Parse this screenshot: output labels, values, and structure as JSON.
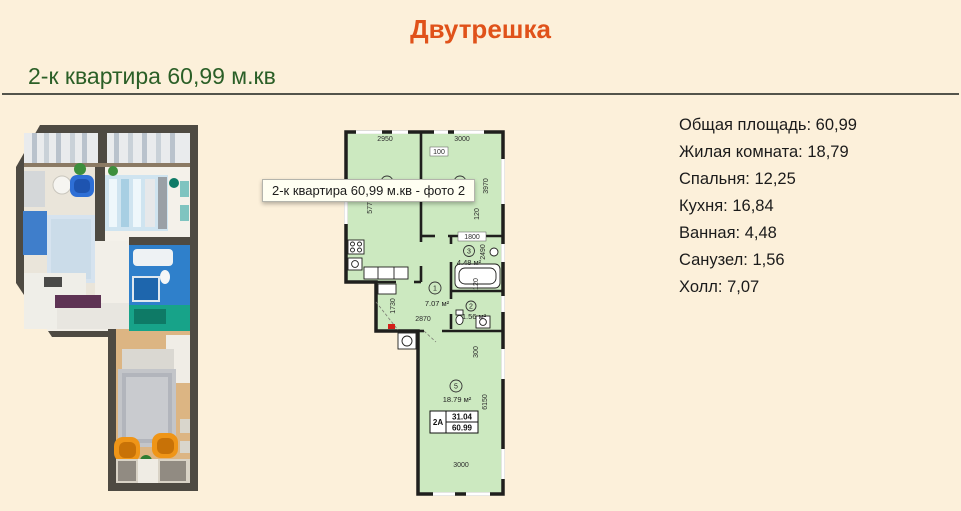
{
  "header": {
    "title": "Двутрешка",
    "subtitle": "2-к квартира 60,99 м.кв"
  },
  "tooltip": {
    "text": "2-к квартира 60,99 м.кв - фото 2"
  },
  "details": {
    "items": [
      {
        "label": "Общая площадь:",
        "value": "60,99"
      },
      {
        "label": "Жилая комната:",
        "value": "18,79"
      },
      {
        "label": "Спальня:",
        "value": "12,25"
      },
      {
        "label": "Кухня:",
        "value": "16,84"
      },
      {
        "label": "Ванная:",
        "value": "4,48"
      },
      {
        "label": "Санузел:",
        "value": "1,56"
      },
      {
        "label": "Холл:",
        "value": "7,07"
      }
    ]
  },
  "floorplan": {
    "rooms": [
      {
        "num": "4",
        "area": "16.84 м²"
      },
      {
        "num": "6",
        "area": "12.25 м²"
      },
      {
        "num": "3",
        "area": "4.48 м²"
      },
      {
        "num": "1",
        "area": "7.07 м²"
      },
      {
        "num": "2",
        "area": "1.56 м²"
      },
      {
        "num": "5",
        "area": "18.79 м²"
      }
    ],
    "dims": {
      "kitchen_width": "2950",
      "bedroom_width": "3000",
      "top_offset": "100",
      "bedroom_height": "3970",
      "bedroom_offset": "120",
      "kitchen_height": "5770",
      "bath_width": "1800",
      "bath_height": "2490",
      "bath_offset": "120",
      "hall_height": "1730",
      "hall_width": "2870",
      "room5_offset": "300",
      "room5_height": "6150",
      "room5_width": "3000"
    },
    "typebox": {
      "code": "2A",
      "living": "31.04",
      "total": "60.99"
    }
  },
  "colors": {
    "page_bg": "#fcf0da",
    "accent_orange": "#e0521a",
    "heading_green": "#2b5f27",
    "plan_fill": "#cce9c0",
    "wall": "#1f1f1d",
    "entry_marker_red": "#d42019"
  }
}
